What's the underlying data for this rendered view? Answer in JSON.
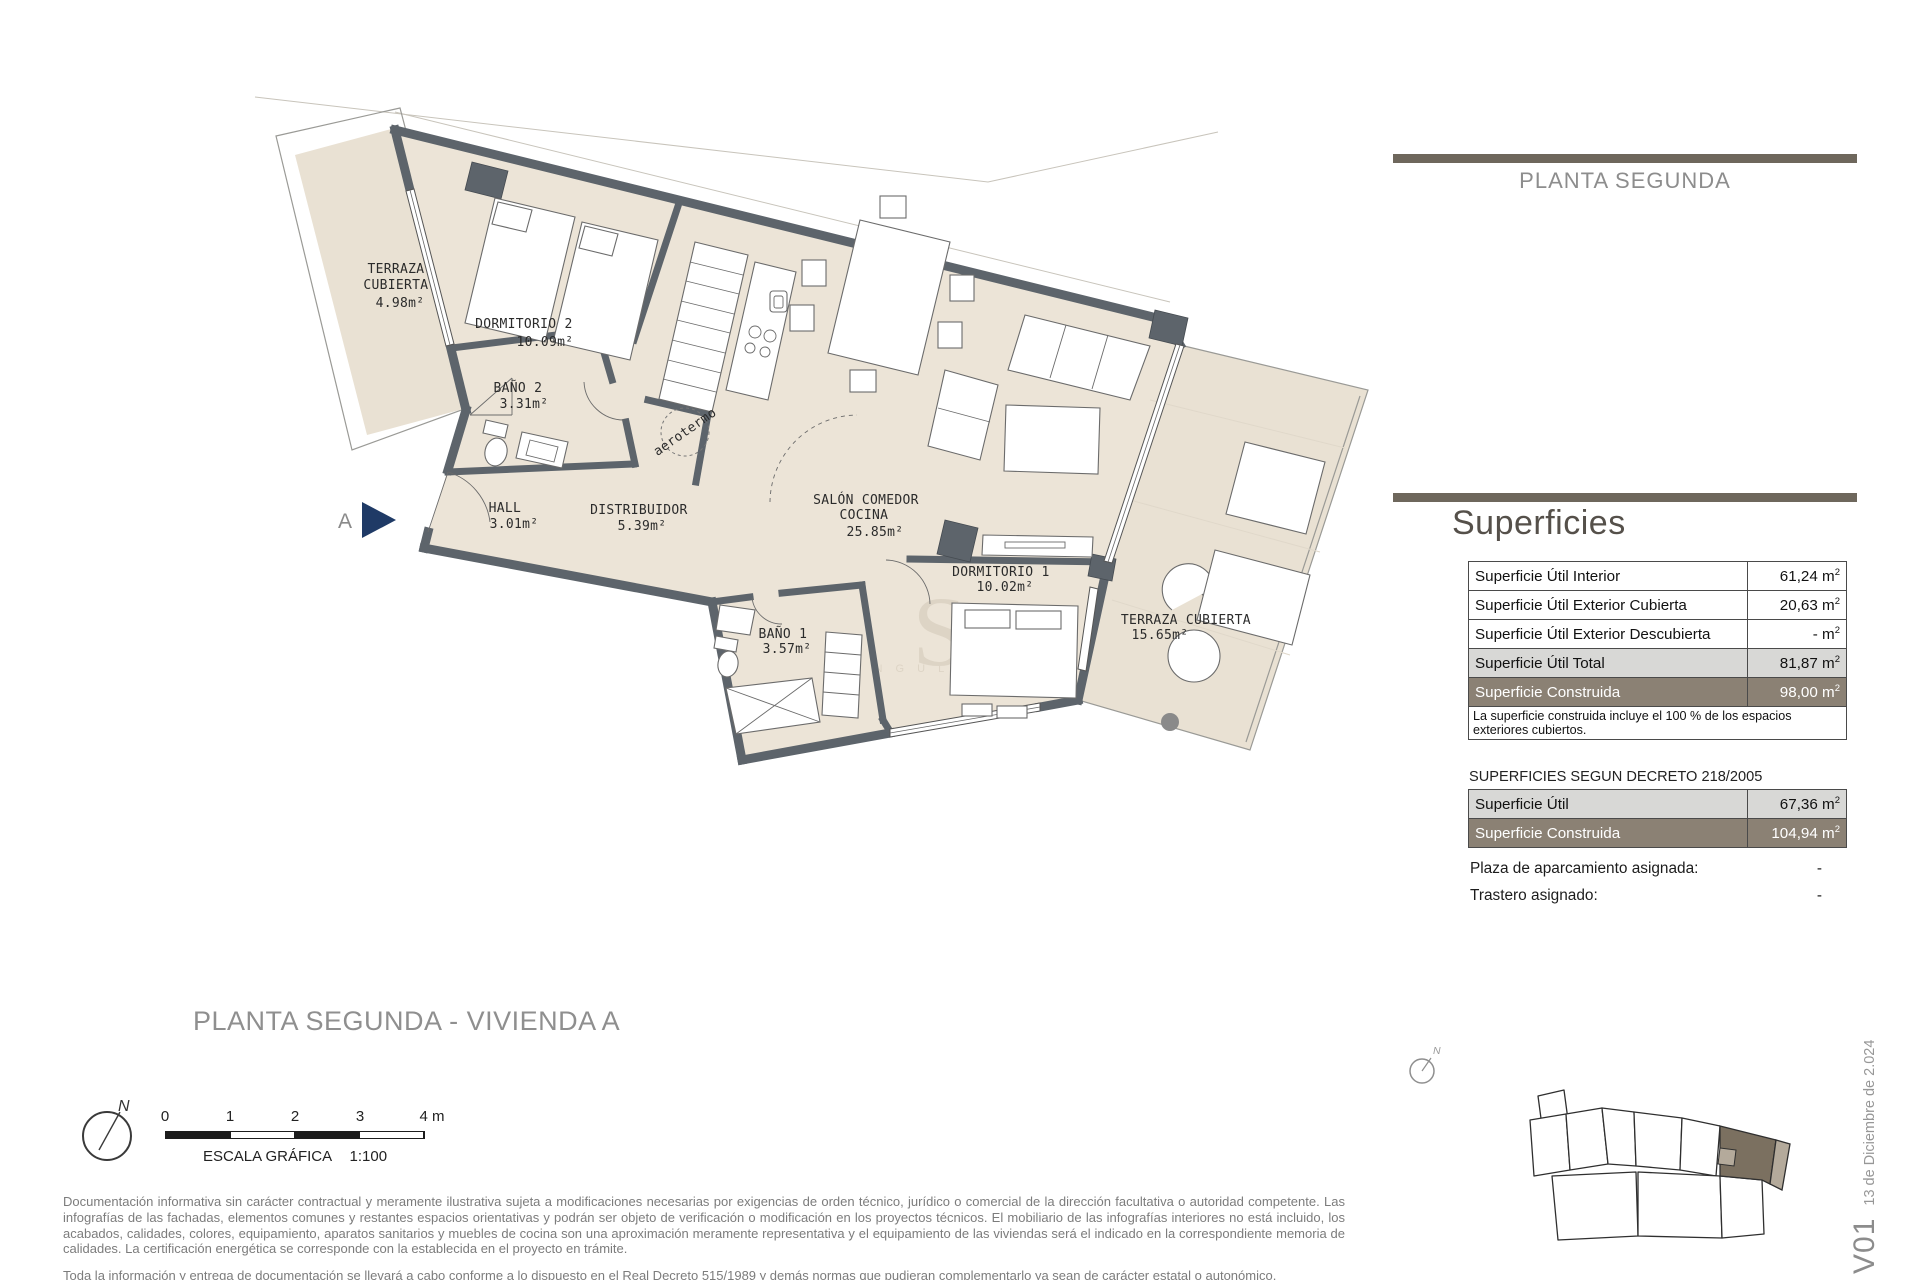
{
  "page_title": "PLANTA SEGUNDA",
  "plan": {
    "rooms": [
      {
        "lines": [
          "TERRAZA",
          "CUBIERTA"
        ],
        "area": "4.98m²"
      },
      {
        "lines": [
          "DORMITORIO 2"
        ],
        "area": "10.09m²"
      },
      {
        "lines": [
          "BAÑO 2"
        ],
        "area": "3.31m²"
      },
      {
        "lines": [
          "HALL"
        ],
        "area": "3.01m²"
      },
      {
        "lines": [
          "DISTRIBUIDOR"
        ],
        "area": "5.39m²"
      },
      {
        "lines": [
          "SALÓN COMEDOR",
          "COCINA"
        ],
        "area": "25.85m²"
      },
      {
        "lines": [
          "DORMITORIO 1"
        ],
        "area": "10.02m²"
      },
      {
        "lines": [
          "BAÑO 1"
        ],
        "area": "3.57m²"
      },
      {
        "lines": [
          "TERRAZA CUBIERTA"
        ],
        "area": "15.65m²"
      }
    ],
    "aerotermo_label": "aerotermo",
    "entrance_label": "A",
    "watermark_letter": "S",
    "watermark_word": "S I N G U L A R"
  },
  "surfaces": {
    "title": "Superficies",
    "unit": "m",
    "unit_exp": "2",
    "main_table": {
      "rows": [
        {
          "label": "Superficie Útil Interior",
          "value": "61,24"
        },
        {
          "label": "Superficie Útil Exterior Cubierta",
          "value": "20,63"
        },
        {
          "label": "Superficie Útil Exterior Descubierta",
          "value": "-"
        },
        {
          "label": "Superficie Útil Total",
          "value": "81,87"
        },
        {
          "label": "Superficie Construida",
          "value": "98,00"
        }
      ],
      "note_line1": "La superficie construida incluye el 100 % de los espacios",
      "note_line2": "exteriores cubiertos."
    },
    "decree_heading": "SUPERFICIES SEGUN DECRETO 218/2005",
    "decree_table": {
      "rows": [
        {
          "label": "Superficie Útil",
          "value": "67,36"
        },
        {
          "label": "Superficie Construida",
          "value": "104,94"
        }
      ]
    },
    "assignments": [
      {
        "label": "Plaza de aparcamiento asignada:",
        "value": "-"
      },
      {
        "label": "Trastero asignado:",
        "value": "-"
      }
    ]
  },
  "footer": {
    "plan_title": "PLANTA SEGUNDA - VIVIENDA A",
    "north_label": "N",
    "scale": {
      "ticks": [
        "0",
        "1",
        "2",
        "3",
        "4 m"
      ],
      "caption": "ESCALA GRÁFICA",
      "ratio": "1:100"
    },
    "disclaimer_p1": "Documentación informativa sin carácter contractual  y  meramente ilustrativa sujeta  a  modificaciones necesarias por exigencias de orden técnico, jurídico  o  comercial de la dirección facultativa  o  autoridad competente. Las infografías de las fachadas, elementos comunes y restantes espacios orientativas y podrán ser objeto de verificación o modificación en los proyectos técnicos. El mobiliario de las infografías interiores no está incluido, los acabados,  calidades,  colores,  equipamiento,  aparatos sanitarios  y  muebles  de  cocina son una aproximación meramente representativa  y  el equipamiento de  las viviendas será el indicado en la correspondiente memoria de calidades. La certificación energética se corresponde con la establecida en el proyecto en trámite.",
    "disclaimer_p2": "Toda la información y entrega de documentación se llevará a cabo conforme a lo dispuesto en el Real Decreto 515/1989 y demás normas que pudieran complementarlo ya sean de carácter estatal o autonómico."
  },
  "version": {
    "code": "V01",
    "date": "13 de Diciembre de 2.024"
  },
  "colors": {
    "accent_bar": "#6e675c",
    "row_brown": "#8b8174",
    "row_gray": "#d8d8d6",
    "floor_beige": "#ece4d7",
    "wall_gray": "#5d646b",
    "entrance_blue": "#1f3a66"
  }
}
